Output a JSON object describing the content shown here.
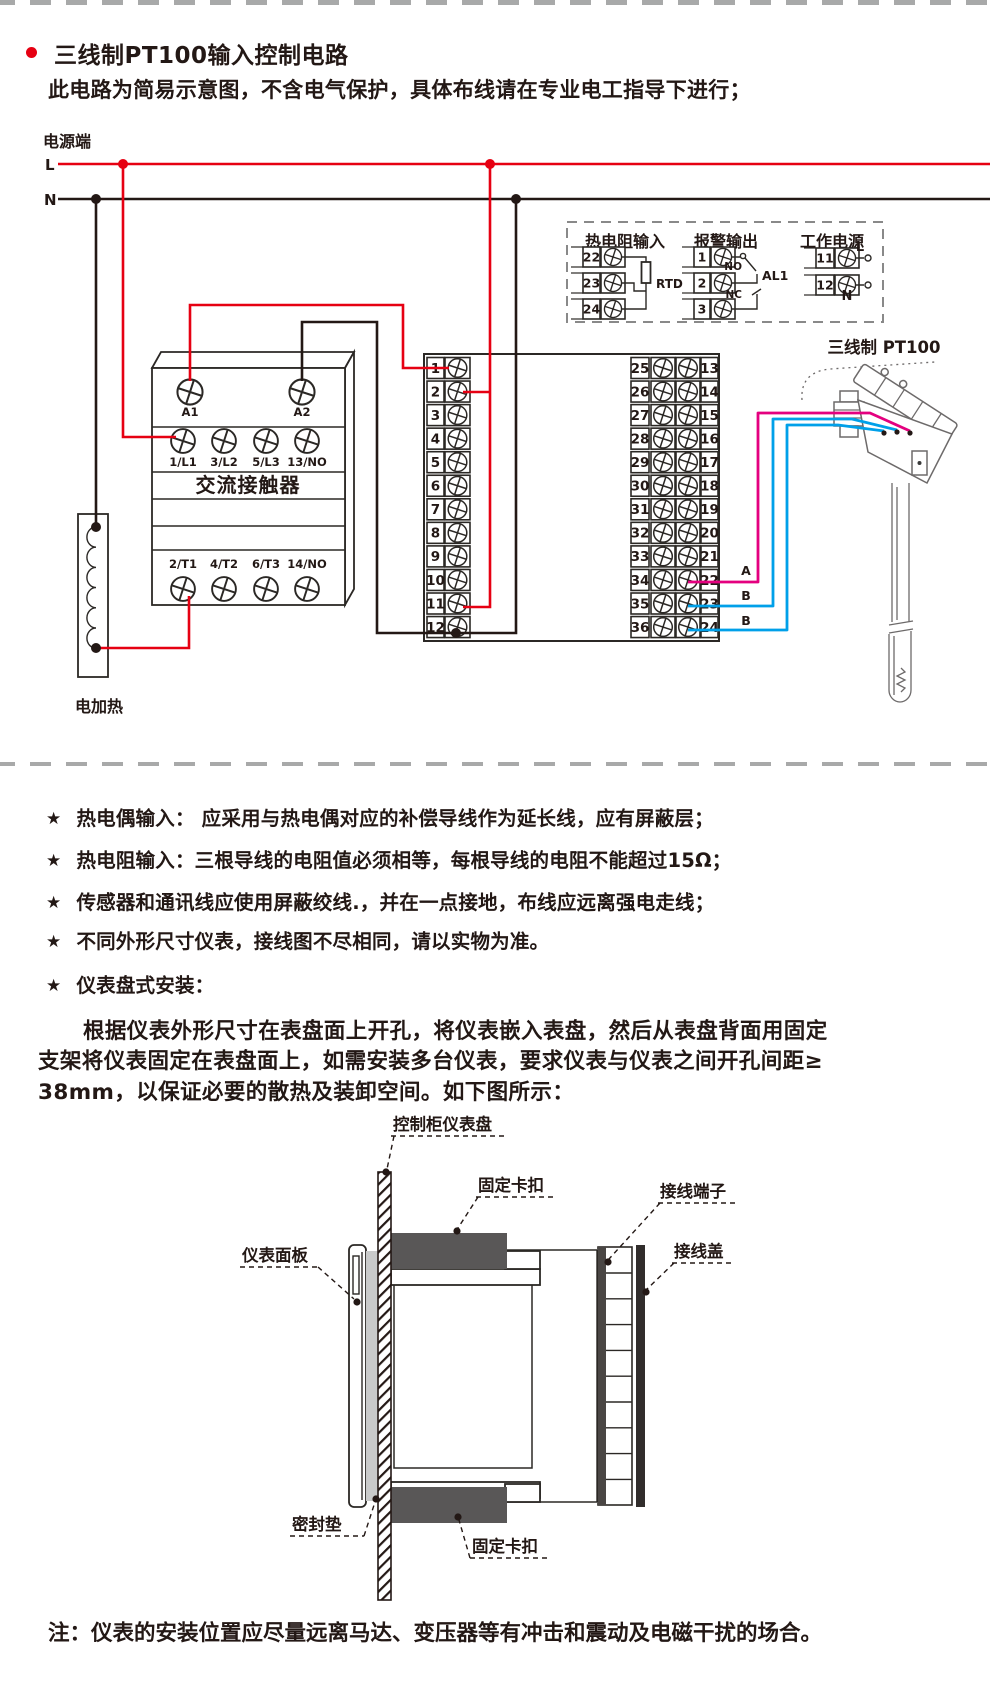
{
  "colors": {
    "accent_red": "#e60012",
    "line_black": "#231815",
    "wire_magenta": "#e4007f",
    "wire_blue": "#00a0e9",
    "clip_gray": "#595757",
    "gasket_gray": "#c9caca",
    "dash_gray": "#a8a9a9"
  },
  "header": {
    "title": "三线制PT100输入控制电路",
    "subtitle": "此电路为简易示意图，不含电气保护，具体布线请在专业电工指导下进行；"
  },
  "circuit": {
    "power_label": "电源端",
    "line_l": "L",
    "line_n": "N",
    "contactor": {
      "name": "交流接触器",
      "coil": [
        "A1",
        "A2"
      ],
      "row_top": [
        "1/L1",
        "3/L2",
        "5/L3",
        "13/NO"
      ],
      "row_bottom": [
        "2/T1",
        "4/T2",
        "6/T3",
        "14/NO"
      ]
    },
    "heater": "电加热",
    "strip1_numbers": [
      "1",
      "2",
      "3",
      "4",
      "5",
      "6",
      "7",
      "8",
      "9",
      "10",
      "11",
      "12"
    ],
    "strip2_left_numbers": [
      "25",
      "26",
      "27",
      "28",
      "29",
      "30",
      "31",
      "32",
      "33",
      "34",
      "35",
      "36"
    ],
    "strip2_right_numbers": [
      "13",
      "14",
      "15",
      "16",
      "17",
      "18",
      "19",
      "20",
      "21",
      "22",
      "23",
      "24"
    ],
    "sensor": {
      "label": "三线制 PT100",
      "wire_labels": [
        "A",
        "B",
        "B"
      ]
    },
    "legend": {
      "rtd": {
        "title": "热电阻输入",
        "terminals": [
          "22",
          "23",
          "24"
        ],
        "component": "RTD"
      },
      "alarm": {
        "title": "报警输出",
        "terminals": [
          "1",
          "2",
          "3"
        ],
        "no": "NO",
        "nc": "NC",
        "name": "AL1"
      },
      "power": {
        "title": "工作电源",
        "terminals": [
          "11",
          "12"
        ],
        "l": "L",
        "n": "N"
      }
    }
  },
  "notes": {
    "bullet": "★",
    "items": [
      "热电偶输入： 应采用与热电偶对应的补偿导线作为延长线，应有屏蔽层；",
      "热电阻输入：三根导线的电阻值必须相等，每根导线的电阻不能超过15Ω；",
      "传感器和通讯线应使用屏蔽绞线.，并在一点接地，布线应远离强电走线；",
      "不同外形尺寸仪表，接线图不尽相同，请以实物为准。",
      "仪表盘式安装："
    ]
  },
  "install": {
    "paragraph": [
      "根据仪表外形尺寸在表盘面上开孔，将仪表嵌入表盘，然后从表盘背面用固定",
      "支架将仪表固定在表盘面上，如需安装多台仪表，要求仪表与仪表之间开孔间距≥",
      "38mm，以保证必要的散热及装卸空间。如下图所示："
    ],
    "labels": {
      "panel": "控制柜仪表盘",
      "clip_top": "固定卡扣",
      "terminals": "接线端子",
      "cover": "接线盖",
      "front_panel": "仪表面板",
      "gasket": "密封垫",
      "clip_bottom": "固定卡扣"
    }
  },
  "footer": {
    "note": "注：仪表的安装位置应尽量远离马达、变压器等有冲击和震动及电磁干扰的场合。"
  }
}
